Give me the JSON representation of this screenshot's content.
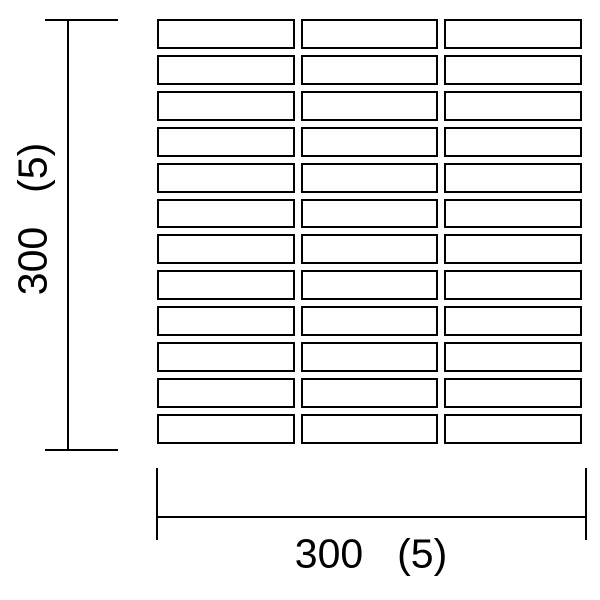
{
  "diagram": {
    "background_color": "#ffffff",
    "line_color": "#000000",
    "tile_grid": {
      "rows": 12,
      "columns": 3
    },
    "dimensions": {
      "vertical": {
        "label": "300 (5)"
      },
      "horizontal": {
        "label": "300 (5)"
      }
    }
  }
}
